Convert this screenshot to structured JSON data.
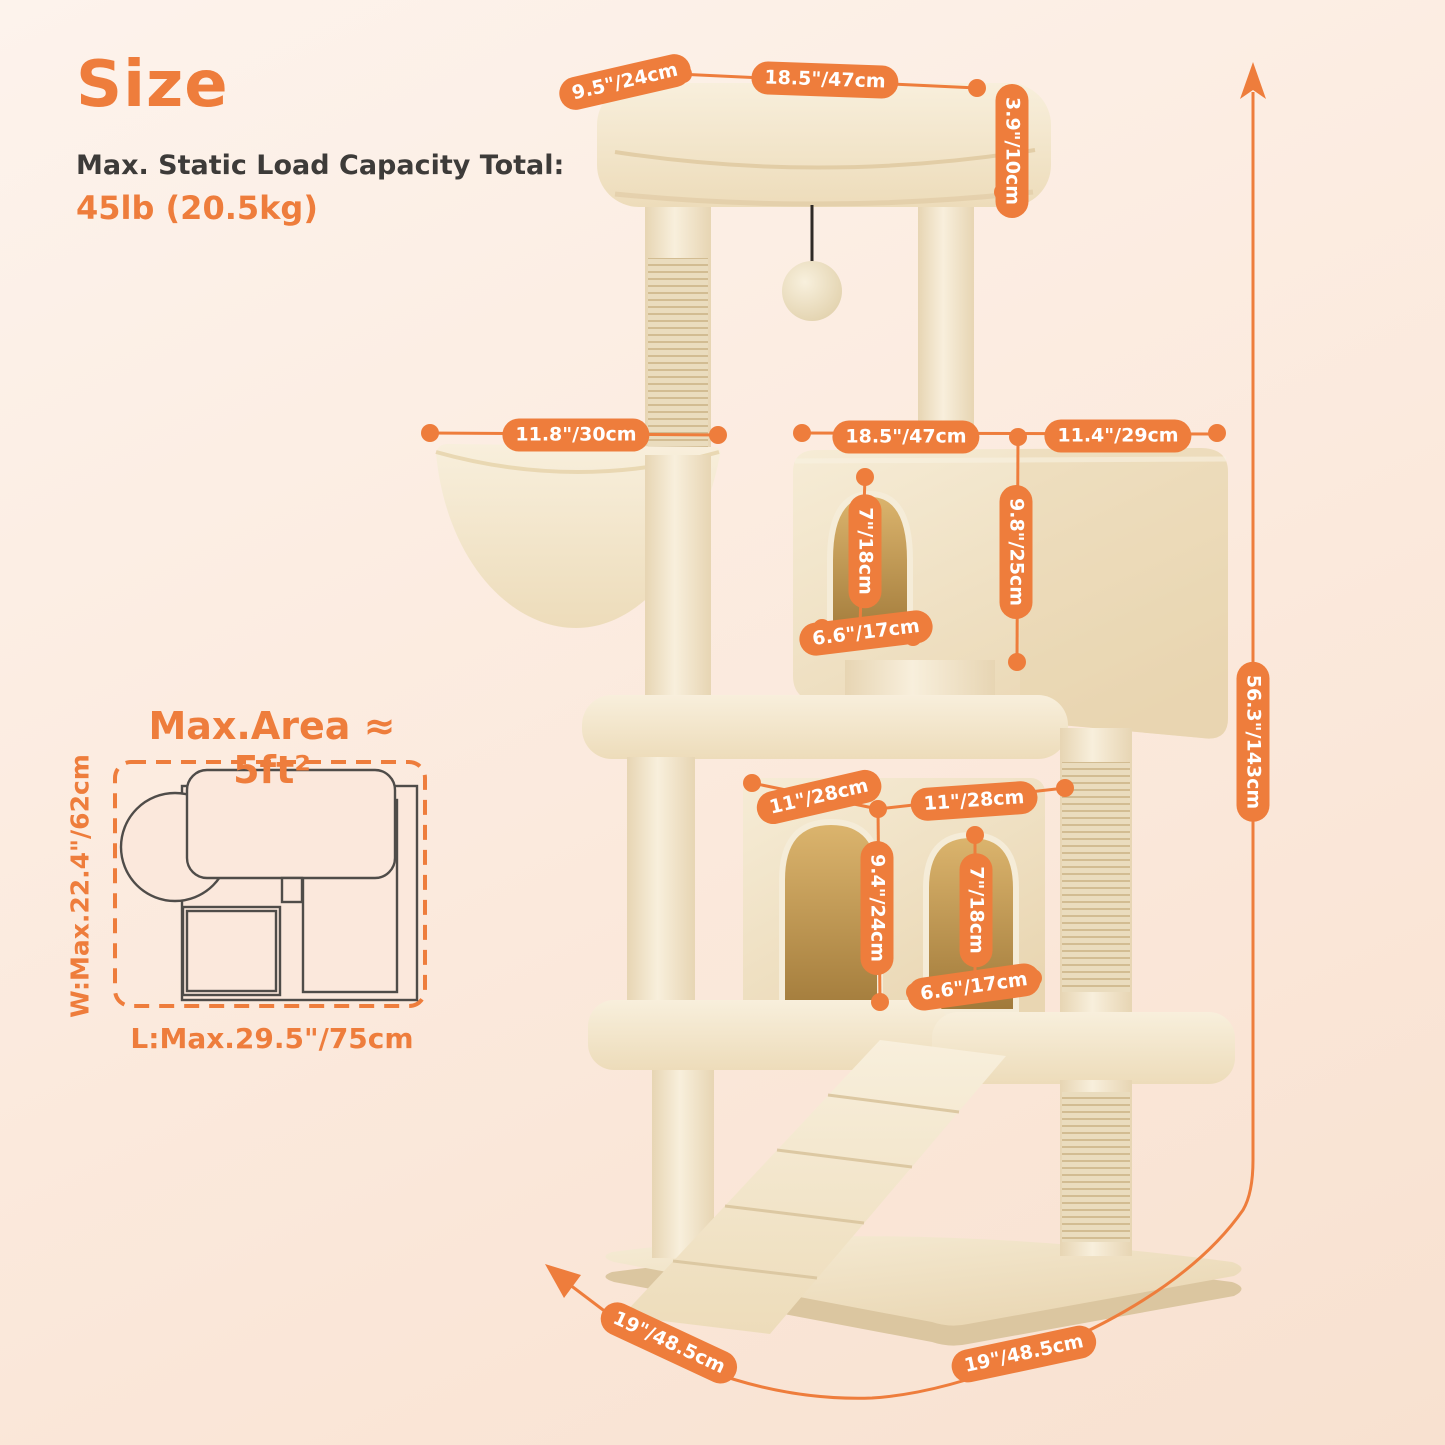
{
  "header": {
    "title": "Size",
    "capacity_label": "Max. Static Load Capacity Total:",
    "capacity_value": "45lb (20.5kg)"
  },
  "floorplan": {
    "title": "Max.Area ≈ 5ft²",
    "width_label": "W:Max.22.4\"/62cm",
    "length_label": "L:Max.29.5\"/75cm"
  },
  "dims": {
    "top_perch_depth": "9.5\"/24cm",
    "top_perch_width": "18.5\"/47cm",
    "top_perch_height": "3.9\"/10cm",
    "basket_diameter": "11.8\"/30cm",
    "upper_condo_width": "18.5\"/47cm",
    "upper_condo_depth": "11.4\"/29cm",
    "upper_condo_height": "9.8\"/25cm",
    "upper_door_height": "7\"/18cm",
    "upper_door_width": "6.6\"/17cm",
    "lower_condo_width": "11\"/28cm",
    "lower_condo_depth": "11\"/28cm",
    "lower_condo_height": "9.4\"/24cm",
    "lower_door_height": "7\"/18cm",
    "lower_door_width": "6.6\"/17cm",
    "total_height": "56.3\"/143cm",
    "base_depth": "19\"/48.5cm",
    "base_width": "19\"/48.5cm"
  },
  "colors": {
    "accent": "#ee7d3c",
    "background_top": "#fdf3ec",
    "background_bottom": "#f8e1d0",
    "text_dark": "#3d3b39",
    "plush": "#f3e6cb",
    "sisal": "#e9dcbe",
    "door_inner": "#c99f58"
  }
}
